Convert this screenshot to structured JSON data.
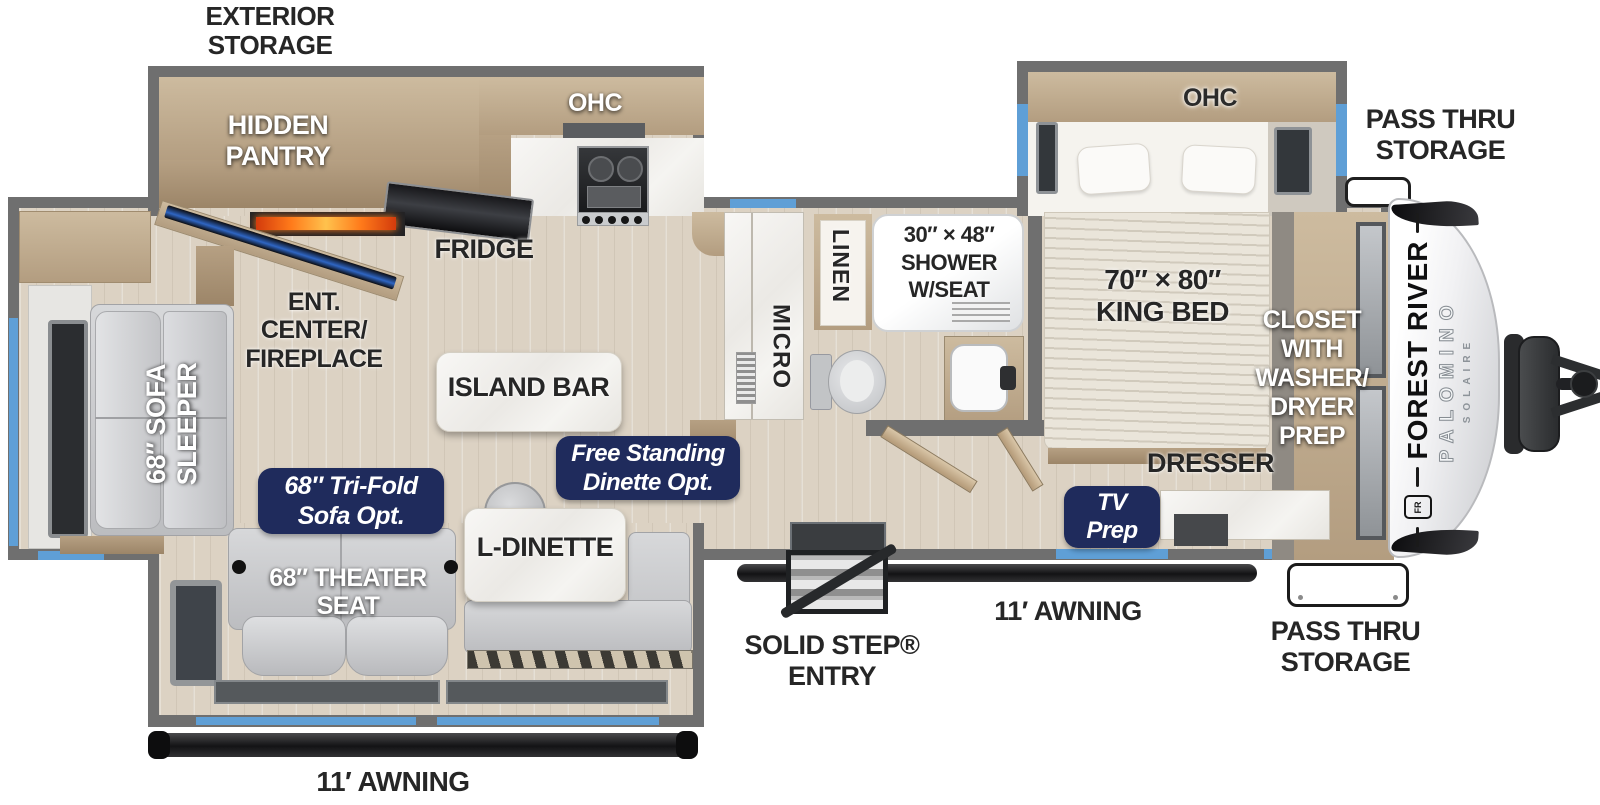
{
  "colors": {
    "wall": "#6f6f6f",
    "floor": "#dcd2c3",
    "window": "#5f9fd6",
    "badge": "#1f2b5c",
    "marble": "#f2f1ee",
    "wood": "#c3b094",
    "label": "#262626"
  },
  "exterior": {
    "storage_top_left": {
      "line1": "EXTERIOR",
      "line2": "STORAGE"
    },
    "pass_thru_top": {
      "line1": "PASS THRU",
      "line2": "STORAGE"
    },
    "pass_thru_bottom": {
      "line1": "PASS THRU",
      "line2": "STORAGE"
    },
    "awning_rear": "11′ AWNING",
    "awning_door": "11′ AWNING",
    "entry": {
      "line1": "SOLID STEP®",
      "line2": "ENTRY"
    }
  },
  "kitchen": {
    "pantry": {
      "line1": "HIDDEN",
      "line2": "PANTRY"
    },
    "ohc": "OHC",
    "fridge": "FRIDGE",
    "island": "ISLAND BAR",
    "micro": "MICRO",
    "ent_center": {
      "line1": "ENT.",
      "line2": "CENTER/",
      "line3": "FIREPLACE"
    }
  },
  "living": {
    "sofa": {
      "line1": "68″ SOFA",
      "line2": "SLEEPER"
    },
    "tri_fold_option": {
      "line1": "68″ Tri-Fold",
      "line2": "Sofa Opt."
    },
    "free_standing_option": {
      "line1": "Free Standing",
      "line2": "Dinette Opt."
    },
    "theater": {
      "line1": "68″ THEATER",
      "line2": "SEAT"
    },
    "dinette": "L-DINETTE"
  },
  "bathroom": {
    "linen": "LINEN",
    "shower": {
      "line1": "30″ × 48″",
      "line2": "SHOWER",
      "line3": "W/SEAT"
    }
  },
  "bedroom": {
    "ohc": "OHC",
    "bed": {
      "line1": "70″ × 80″",
      "line2": "KING BED"
    },
    "closet": {
      "line1": "CLOSET",
      "line2": "WITH",
      "line3": "WASHER/",
      "line4": "DRYER",
      "line5": "PREP"
    },
    "dresser": "DRESSER",
    "tv_prep": {
      "line1": "TV",
      "line2": "Prep"
    }
  },
  "brand": {
    "maker": "FOREST RIVER",
    "model": "PALOMINO",
    "trim": "SOLAIRE",
    "emblem": "FR"
  }
}
